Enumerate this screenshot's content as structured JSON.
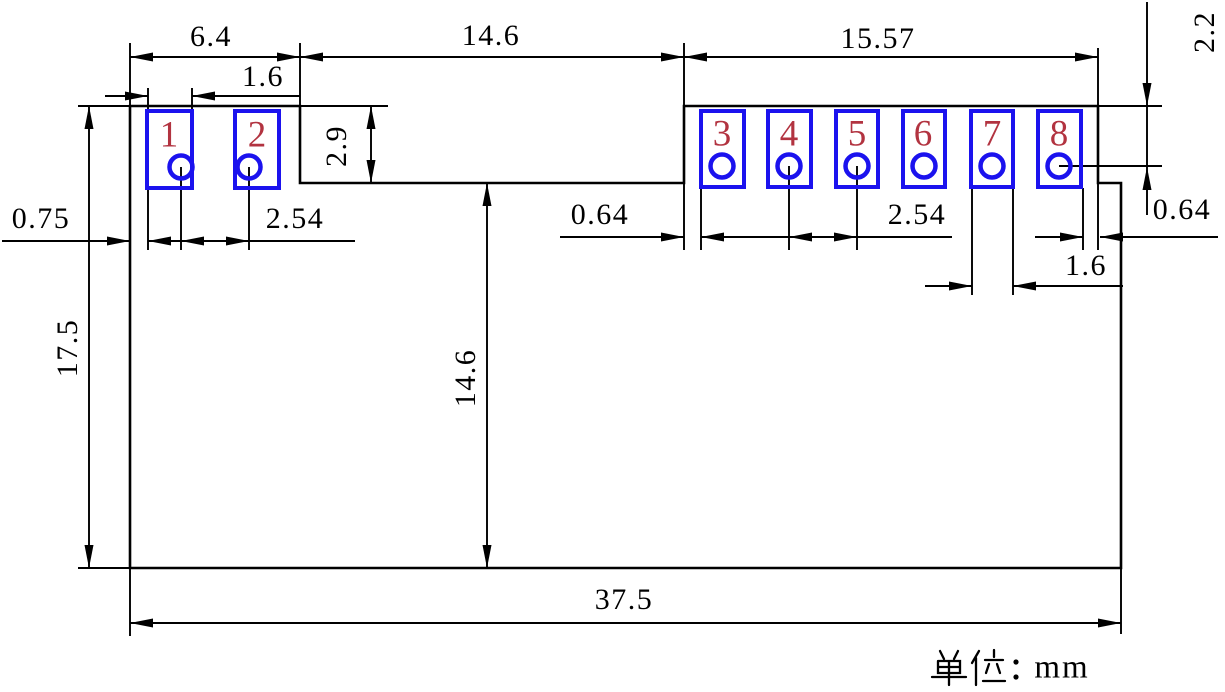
{
  "drawing": {
    "type": "mechanical-dimension-drawing",
    "units": {
      "label": "单位：mm",
      "latin": "mm"
    },
    "pads": [
      {
        "number": "1"
      },
      {
        "number": "2"
      },
      {
        "number": "3"
      },
      {
        "number": "4"
      },
      {
        "number": "5"
      },
      {
        "number": "6"
      },
      {
        "number": "7"
      },
      {
        "number": "8"
      }
    ],
    "dimensions": {
      "top_left_section_width": "6.4",
      "top_middle_gap_width": "14.6",
      "top_right_section_width": "15.57",
      "pad1_width": "1.6",
      "left_notch_depth": "2.9",
      "left_edge_to_pad1": "0.75",
      "left_pad_pitch": "2.54",
      "notch_to_pad3": "0.64",
      "right_pad_pitch": "2.54",
      "top_edge_to_hole8": "2.2",
      "hole8_to_step": "0.64",
      "pad7_width": "1.6",
      "board_height": "17.5",
      "notch_bottom_to_board_bottom": "14.6",
      "board_width": "37.5"
    },
    "colors": {
      "line": "#000000",
      "pad_outline": "#1b12ee",
      "pad_number": "#b23340",
      "background": "#ffffff"
    }
  }
}
